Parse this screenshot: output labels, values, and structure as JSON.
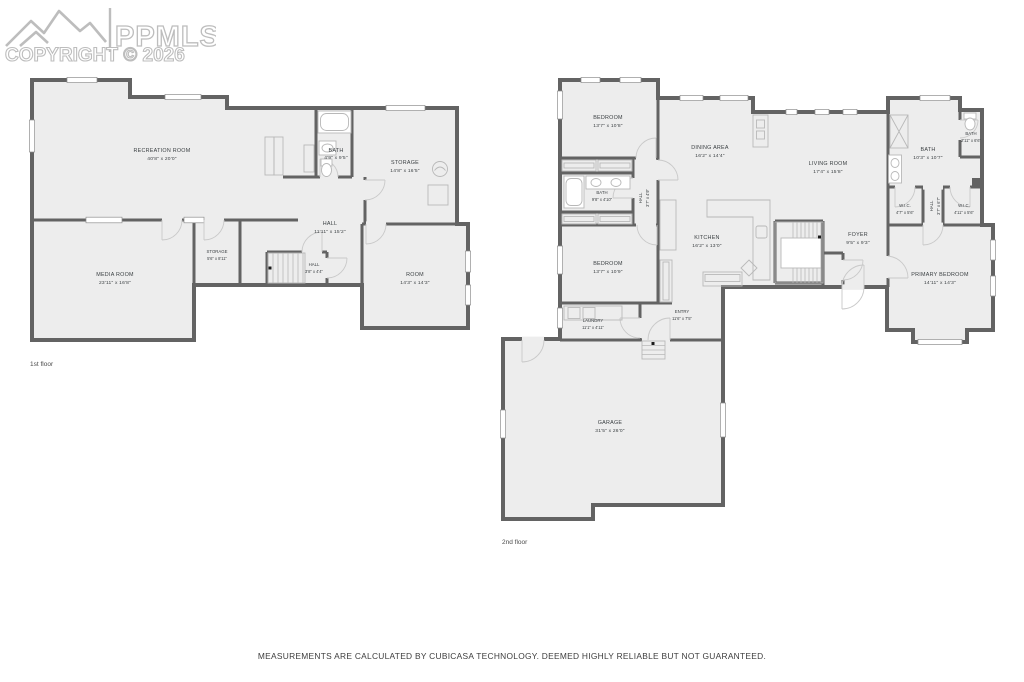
{
  "watermark": {
    "brand": "PPMLS",
    "copyright": "COPYRIGHT © 2026"
  },
  "footer": {
    "disclaimer": "MEASUREMENTS ARE CALCULATED BY CUBICASA TECHNOLOGY. DEEMED HIGHLY RELIABLE BUT NOT GUARANTEED."
  },
  "floors": {
    "floor1": {
      "caption": "1st floor",
      "rooms": {
        "recreation": {
          "name": "RECREATION ROOM",
          "dims": "40'8\" x 20'0\""
        },
        "bath": {
          "name": "BATH",
          "dims": "4'9\" x 9'5\""
        },
        "storage_big": {
          "name": "STORAGE",
          "dims": "14'8\" x 16'5\""
        },
        "hall_big": {
          "name": "HALL",
          "dims": "11'11\" x 15'2\""
        },
        "media": {
          "name": "MEDIA ROOM",
          "dims": "23'11\" x 16'8\""
        },
        "storage_small": {
          "name": "STORAGE",
          "dims": "5'6\" x 8'11\""
        },
        "hall_small": {
          "name": "HALL",
          "dims": "3'8\" x 4'4\""
        },
        "room": {
          "name": "ROOM",
          "dims": "14'3\" x 14'3\""
        }
      }
    },
    "floor2": {
      "caption": "2nd floor",
      "rooms": {
        "bedroom1": {
          "name": "BEDROOM",
          "dims": "13'7\" x 10'8\""
        },
        "dining": {
          "name": "DINING AREA",
          "dims": "16'2\" x 14'4\""
        },
        "living": {
          "name": "LIVING ROOM",
          "dims": "17'4\" x 15'8\""
        },
        "bath1": {
          "name": "BATH",
          "dims": "9'8\" x 4'10\""
        },
        "hall1": {
          "name": "HALL",
          "dims": "3'7\" x 4'9\""
        },
        "bath2": {
          "name": "BATH",
          "dims": "10'3\" x 10'7\""
        },
        "bath3": {
          "name": "BATH",
          "dims": "2'11\" x 6'6\""
        },
        "wic1": {
          "name": "W.I.C.",
          "dims": "4'7\" x 5'6\""
        },
        "hall2": {
          "name": "HALL",
          "dims": "3'7\" x 6'7\""
        },
        "wic2": {
          "name": "W.I.C.",
          "dims": "4'11\" x 5'6\""
        },
        "bedroom2": {
          "name": "BEDROOM",
          "dims": "13'7\" x 10'9\""
        },
        "kitchen": {
          "name": "KITCHEN",
          "dims": "16'2\" x 13'0\""
        },
        "foyer": {
          "name": "FOYER",
          "dims": "9'5\" x 9'3\""
        },
        "primary": {
          "name": "PRIMARY BEDROOM",
          "dims": "14'11\" x 14'3\""
        },
        "laundry": {
          "name": "LAUNDRY",
          "dims": "11'1\" x 4'11\""
        },
        "entry": {
          "name": "ENTRY",
          "dims": "11'6\" x 7'5\""
        },
        "garage": {
          "name": "GARAGE",
          "dims": "31'5\" x 26'0\""
        }
      }
    }
  }
}
